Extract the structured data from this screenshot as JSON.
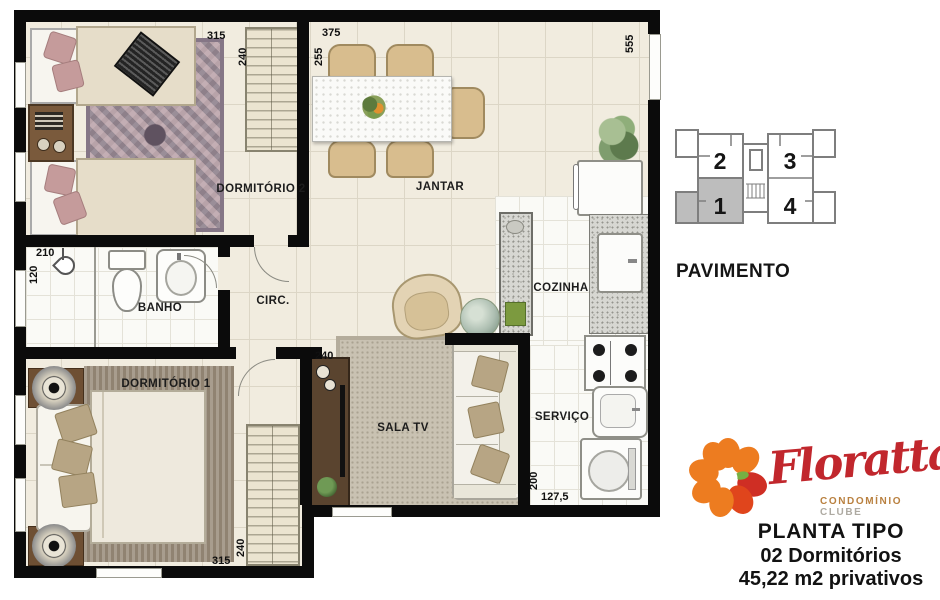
{
  "plan": {
    "rooms": {
      "dormitorio2": {
        "label": "DORMITÓRIO 2"
      },
      "jantar": {
        "label": "JANTAR"
      },
      "banho": {
        "label": "BANHO"
      },
      "circ": {
        "label": "CIRC."
      },
      "cozinha": {
        "label": "COZINHA"
      },
      "sala_tv": {
        "label": "SALA TV"
      },
      "dormitorio1": {
        "label": "DORMITÓRIO 1"
      },
      "servico": {
        "label": "SERVIÇO"
      }
    },
    "dimensions": {
      "dorm2_width": "315",
      "dorm2_depth": "240",
      "jantar_width": "375",
      "jantar_depth": "255",
      "right_side": "555",
      "banho_width": "210",
      "banho_depth": "120",
      "sala_wall": "240",
      "dorm1_width": "315",
      "dorm1_depth": "240",
      "servico_depth": "200",
      "servico_width": "127,5"
    }
  },
  "pavimento": {
    "title": "PAVIMENTO",
    "units": [
      "2",
      "3",
      "1",
      "4"
    ],
    "highlighted_unit": "1"
  },
  "branding": {
    "name": "Floratta",
    "tagline_bold": "CONDOMÍNIO",
    "tagline_light": "CLUBE",
    "plan_type": "PLANTA TIPO",
    "bedrooms": "02 Dormitórios",
    "area": "45,22 m2 privativos"
  },
  "colors": {
    "wall": "#0b0b0b",
    "floor_cream": "#f1ecdf",
    "logo_orange": "#ed7c20",
    "logo_red": "#c1272d",
    "unit_highlight": "#bdbdbd"
  }
}
